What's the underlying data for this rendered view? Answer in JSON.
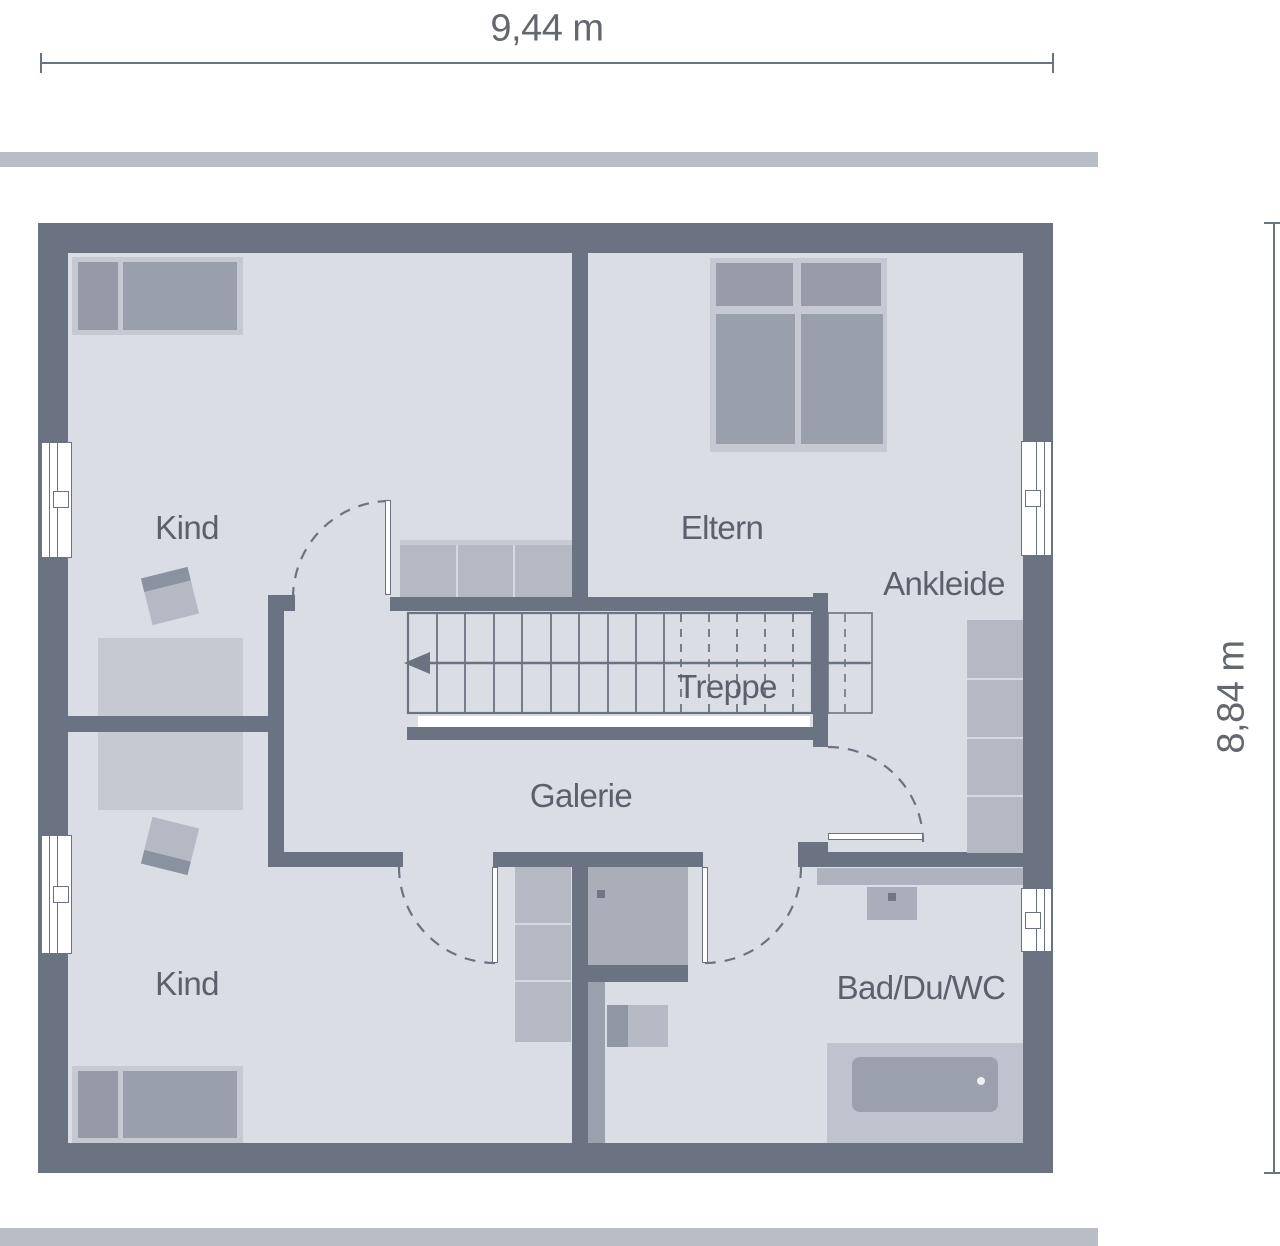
{
  "dimensions": {
    "width": "9,44 m",
    "height": "8,84 m"
  },
  "room_labels": {
    "kind_top": "Kind",
    "eltern": "Eltern",
    "ankleide": "Ankleide",
    "treppe": "Treppe",
    "galerie": "Galerie",
    "kind_bottom": "Kind",
    "bad": "Bad/Du/WC"
  },
  "stair": {
    "direction_arrow": "left",
    "solid_treads": 10,
    "dashed_treads": 5
  },
  "colors": {
    "wall": "#6b7383",
    "floor": "#dadde4",
    "furniture_light": "#c6c9d2",
    "furniture_medium": "#9aa0ab",
    "cabinet": "#b4b9c4",
    "chair_accent": "#8a91a0",
    "roof_bar": "#b9bdc6",
    "dimension_line": "#6b7280",
    "text": "#5a616c"
  }
}
